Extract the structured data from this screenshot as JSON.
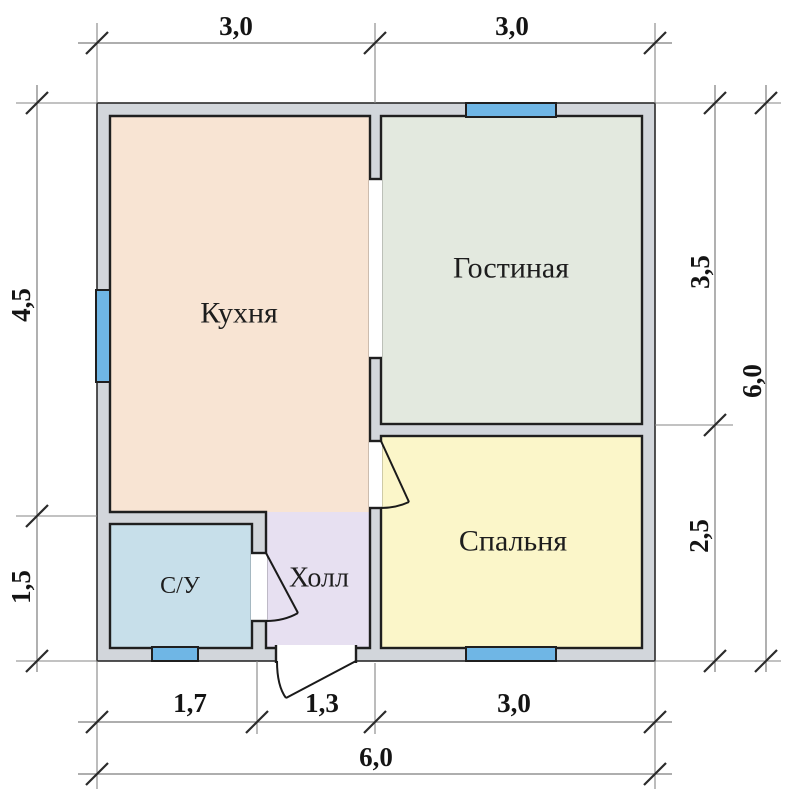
{
  "plan_title": "floor-plan",
  "rooms": {
    "kitchen": {
      "label": "Кухня",
      "color": "#f8e4d3"
    },
    "living_room": {
      "label": "Гостиная",
      "color": "#e3e9df"
    },
    "bedroom": {
      "label": "Спальня",
      "color": "#fbf6c9"
    },
    "hall": {
      "label": "Холл",
      "color": "#e7e0f1"
    },
    "bathroom": {
      "label": "С/У",
      "color": "#c7dfea"
    }
  },
  "dimensions": {
    "top": {
      "seg1": "3,0",
      "seg2": "3,0"
    },
    "left": {
      "seg1": "4,5",
      "seg2": "1,5"
    },
    "right": {
      "seg1": "3,5",
      "seg2": "2,5",
      "total": "6,0"
    },
    "bottom": {
      "seg1": "1,7",
      "seg2": "1,3",
      "seg3": "3,0",
      "total": "6,0"
    }
  },
  "colors": {
    "wall": "#d2d6db",
    "window": "#6fb6e5",
    "outline": "#1f1f1f",
    "dimension_line": "#7d7d7d",
    "background": "#ffffff"
  }
}
